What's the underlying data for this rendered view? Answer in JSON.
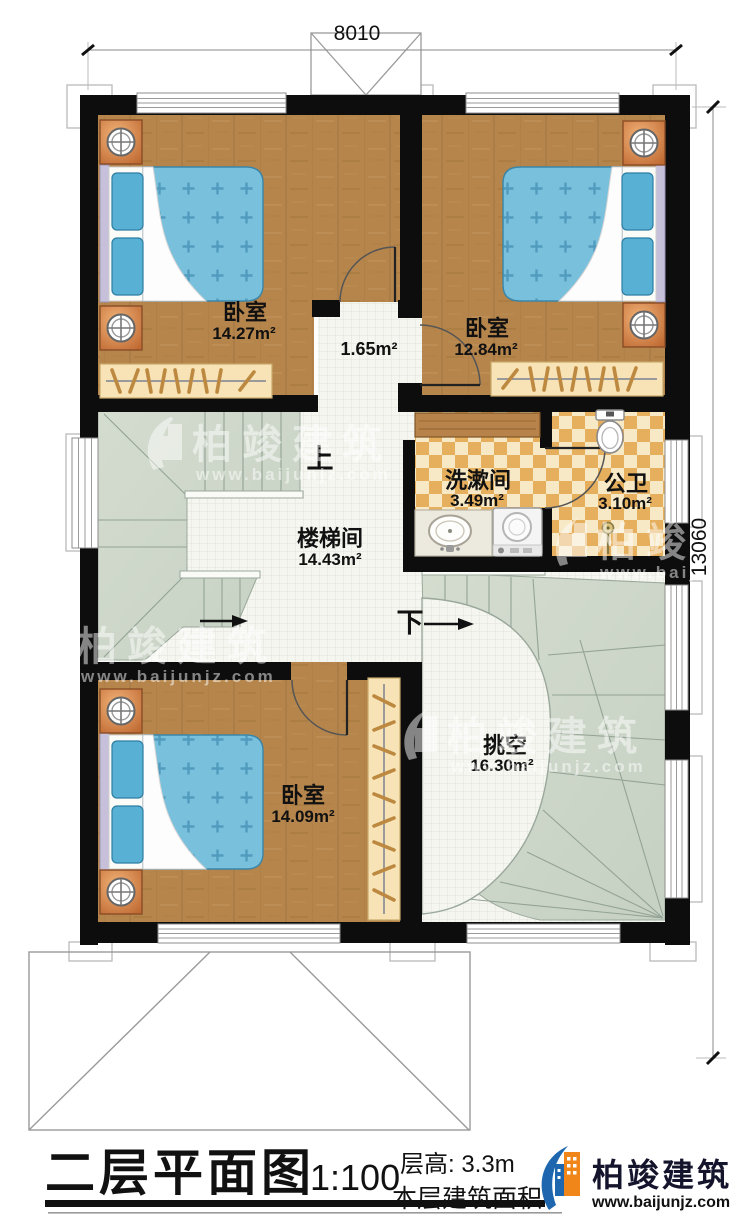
{
  "dimensions": {
    "top_width": "8010",
    "right_height": "13060"
  },
  "rooms": {
    "bedroom_top_left": {
      "name": "卧室",
      "area": "14.27m²"
    },
    "bedroom_top_right": {
      "name": "卧室",
      "area": "12.84m²"
    },
    "bedroom_bottom": {
      "name": "卧室",
      "area": "14.09m²"
    },
    "stairwell": {
      "name": "楼梯间",
      "area": "14.43m²"
    },
    "washroom": {
      "name": "洗漱间",
      "area": "3.49m²"
    },
    "bathroom": {
      "name": "公卫",
      "area": "3.10m²"
    },
    "void": {
      "name": "挑空",
      "area": "16.30m²"
    },
    "corridor": {
      "area": "1.65m²"
    }
  },
  "stairs": {
    "up_label": "上",
    "down_label": "下"
  },
  "titleblock": {
    "title": "二层平面图",
    "scale": "1:100",
    "floor_height": "层高: 3.3m",
    "floor_area_label": "本层建筑面积"
  },
  "brand": {
    "name": "柏竣建筑",
    "url": "www.baijunjz.com"
  },
  "watermark": {
    "name": "柏竣建筑",
    "url": "www.baijunjz.com"
  },
  "colors": {
    "wall": "#0d0d0d",
    "wood_floor": "#b5854c",
    "stair_sage": "#cfd8ca",
    "white_tile": "#f6f6f1",
    "tile_dark": "#e5af5e",
    "tile_light": "#f7e8c6",
    "bed_blue": "#79c0dc",
    "pillow_blue": "#58b1d4",
    "headboard": "#c7c0da",
    "nightstand_orange": "#dd9055",
    "wardrobe_tan": "#f7e3b5",
    "logo_blue": "#1e66ad",
    "logo_orange": "#f08519"
  }
}
